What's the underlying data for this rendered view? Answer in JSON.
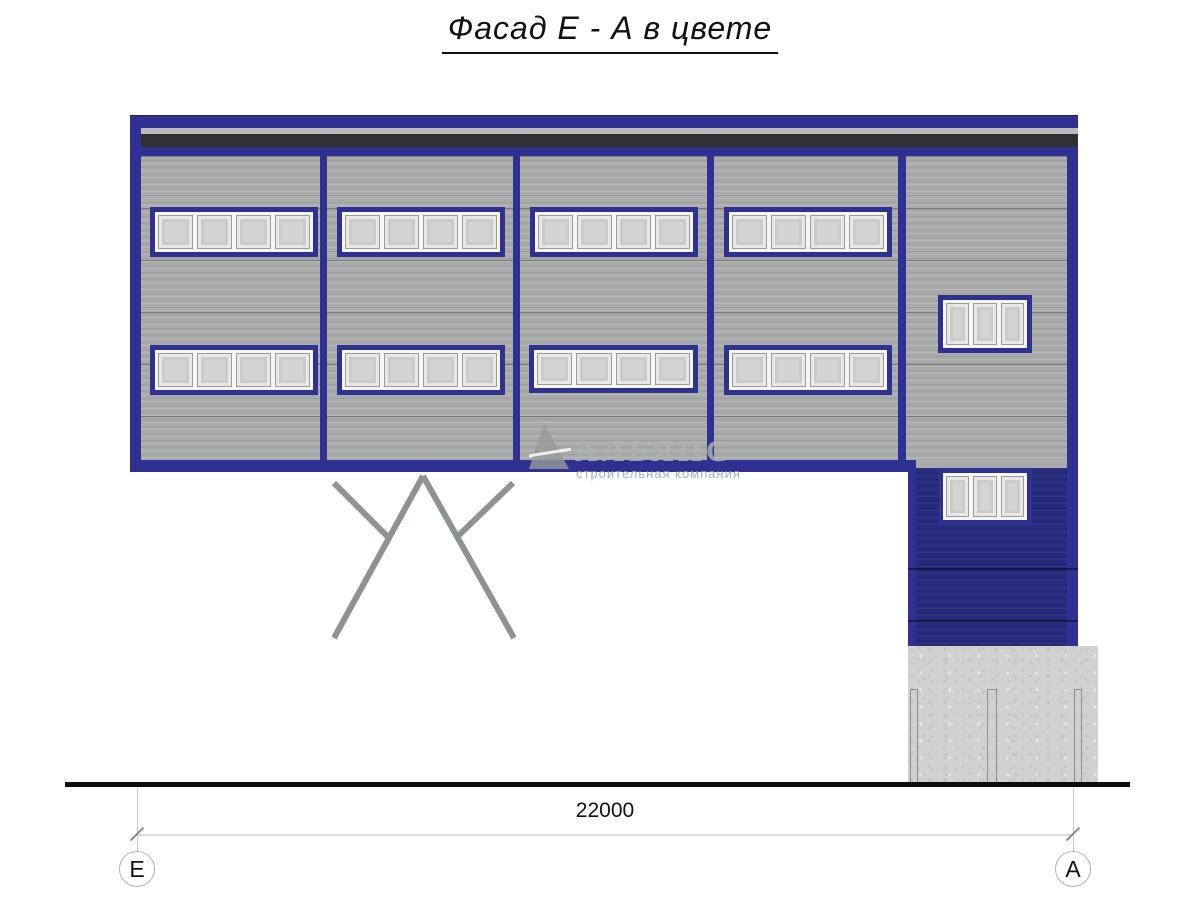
{
  "title": "Фасад Е - А в цвете",
  "watermark": {
    "company": "АЛЬЯНС",
    "tagline": "строительная компания"
  },
  "dimension": {
    "length_label": "22000",
    "axis_start": "Е",
    "axis_end": "А"
  },
  "colors": {
    "frame_blue": "#2e3192",
    "wall_blue": "#262b7d",
    "siding_gray": "#a9abaa",
    "flashing_gray": "#b9bbba",
    "dark_band": "#2f3133",
    "concrete": "#d0d2cf",
    "column_gray": "#9aa09f",
    "glass": "#d4d5d3"
  }
}
